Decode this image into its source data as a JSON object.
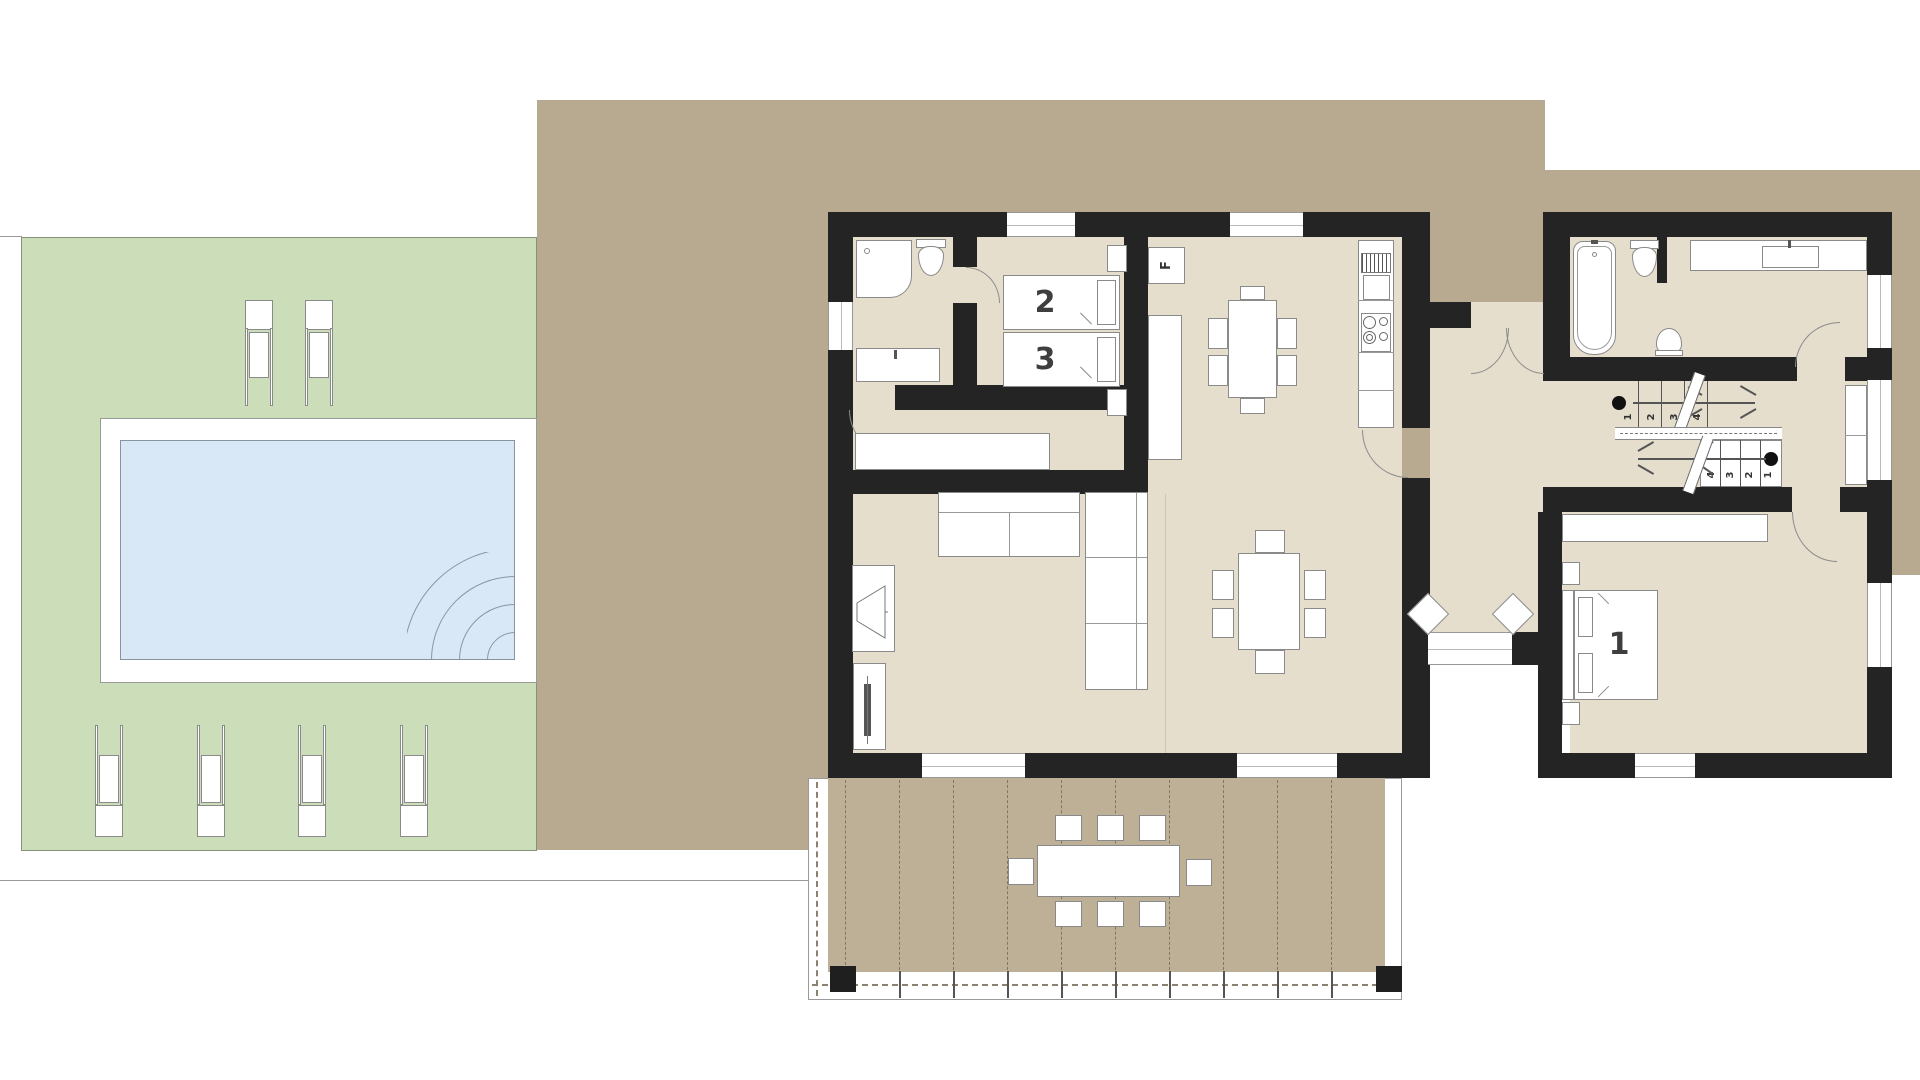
{
  "title": "single-storey house floor plan with pool garden and terrace",
  "labels": {
    "bedroom1_bed": "1",
    "bedroom2_bed2": "2",
    "bedroom2_bed3": "3",
    "fridge": "F"
  },
  "stairs": {
    "flight_up_steps": [
      "1",
      "2",
      "3",
      "4"
    ],
    "flight_down_steps": [
      "4",
      "3",
      "2",
      "1"
    ]
  },
  "colors": {
    "wall": "#242424",
    "interior_floor": "#e5decc",
    "site_tan": "#b7aa91",
    "terrace_deck": "#bdb096",
    "garden_green": "#ccdeb9",
    "pool_water": "#d8e8f6",
    "outline_gray": "#8a8a8a",
    "label_text": "#3e3e3e"
  }
}
